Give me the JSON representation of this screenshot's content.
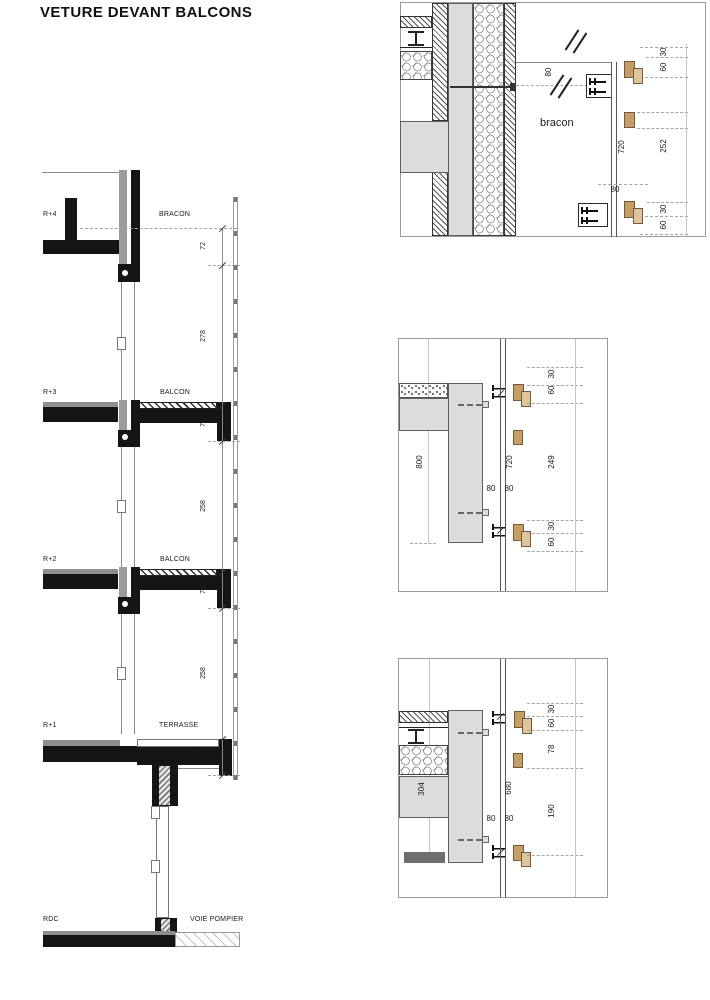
{
  "title": "VETURE DEVANT BALCONS",
  "section": {
    "floors": [
      {
        "level": "R+4",
        "zone": "BRACON"
      },
      {
        "level": "R+3",
        "zone": "BALCON"
      },
      {
        "level": "R+2",
        "zone": "BALCON"
      },
      {
        "level": "R+1",
        "zone": "TERRASSE"
      },
      {
        "level": "RDC",
        "zone": "VOIE POMPIER"
      }
    ],
    "dims": [
      "72",
      "278",
      "72",
      "258",
      "72",
      "258",
      "8"
    ]
  },
  "details": {
    "top": {
      "label": "bracon",
      "dim_offset_top": "80",
      "dim_rail": "720",
      "dim_offset_bottom": "80",
      "right": [
        "30",
        "60",
        "252",
        "30",
        "60"
      ]
    },
    "mid": {
      "dim_height": "800",
      "dim_rail": "720",
      "dim_gap_left": "80",
      "dim_gap_right": "80",
      "right": [
        "30",
        "60",
        "249",
        "30",
        "60"
      ]
    },
    "bot": {
      "dim_height": "304",
      "dim_rail": "680",
      "dim_gap_left": "80",
      "dim_gap_right": "80",
      "right": [
        "30",
        "60",
        "78",
        "190"
      ]
    }
  },
  "colors": {
    "concrete": "#dcdcdc",
    "slab_black": "#151515",
    "band_gray": "#8f8f8f",
    "wood_dark": "#c79e66",
    "wood_light": "#e0c59c",
    "dark_bar": "#6e6e6e"
  }
}
